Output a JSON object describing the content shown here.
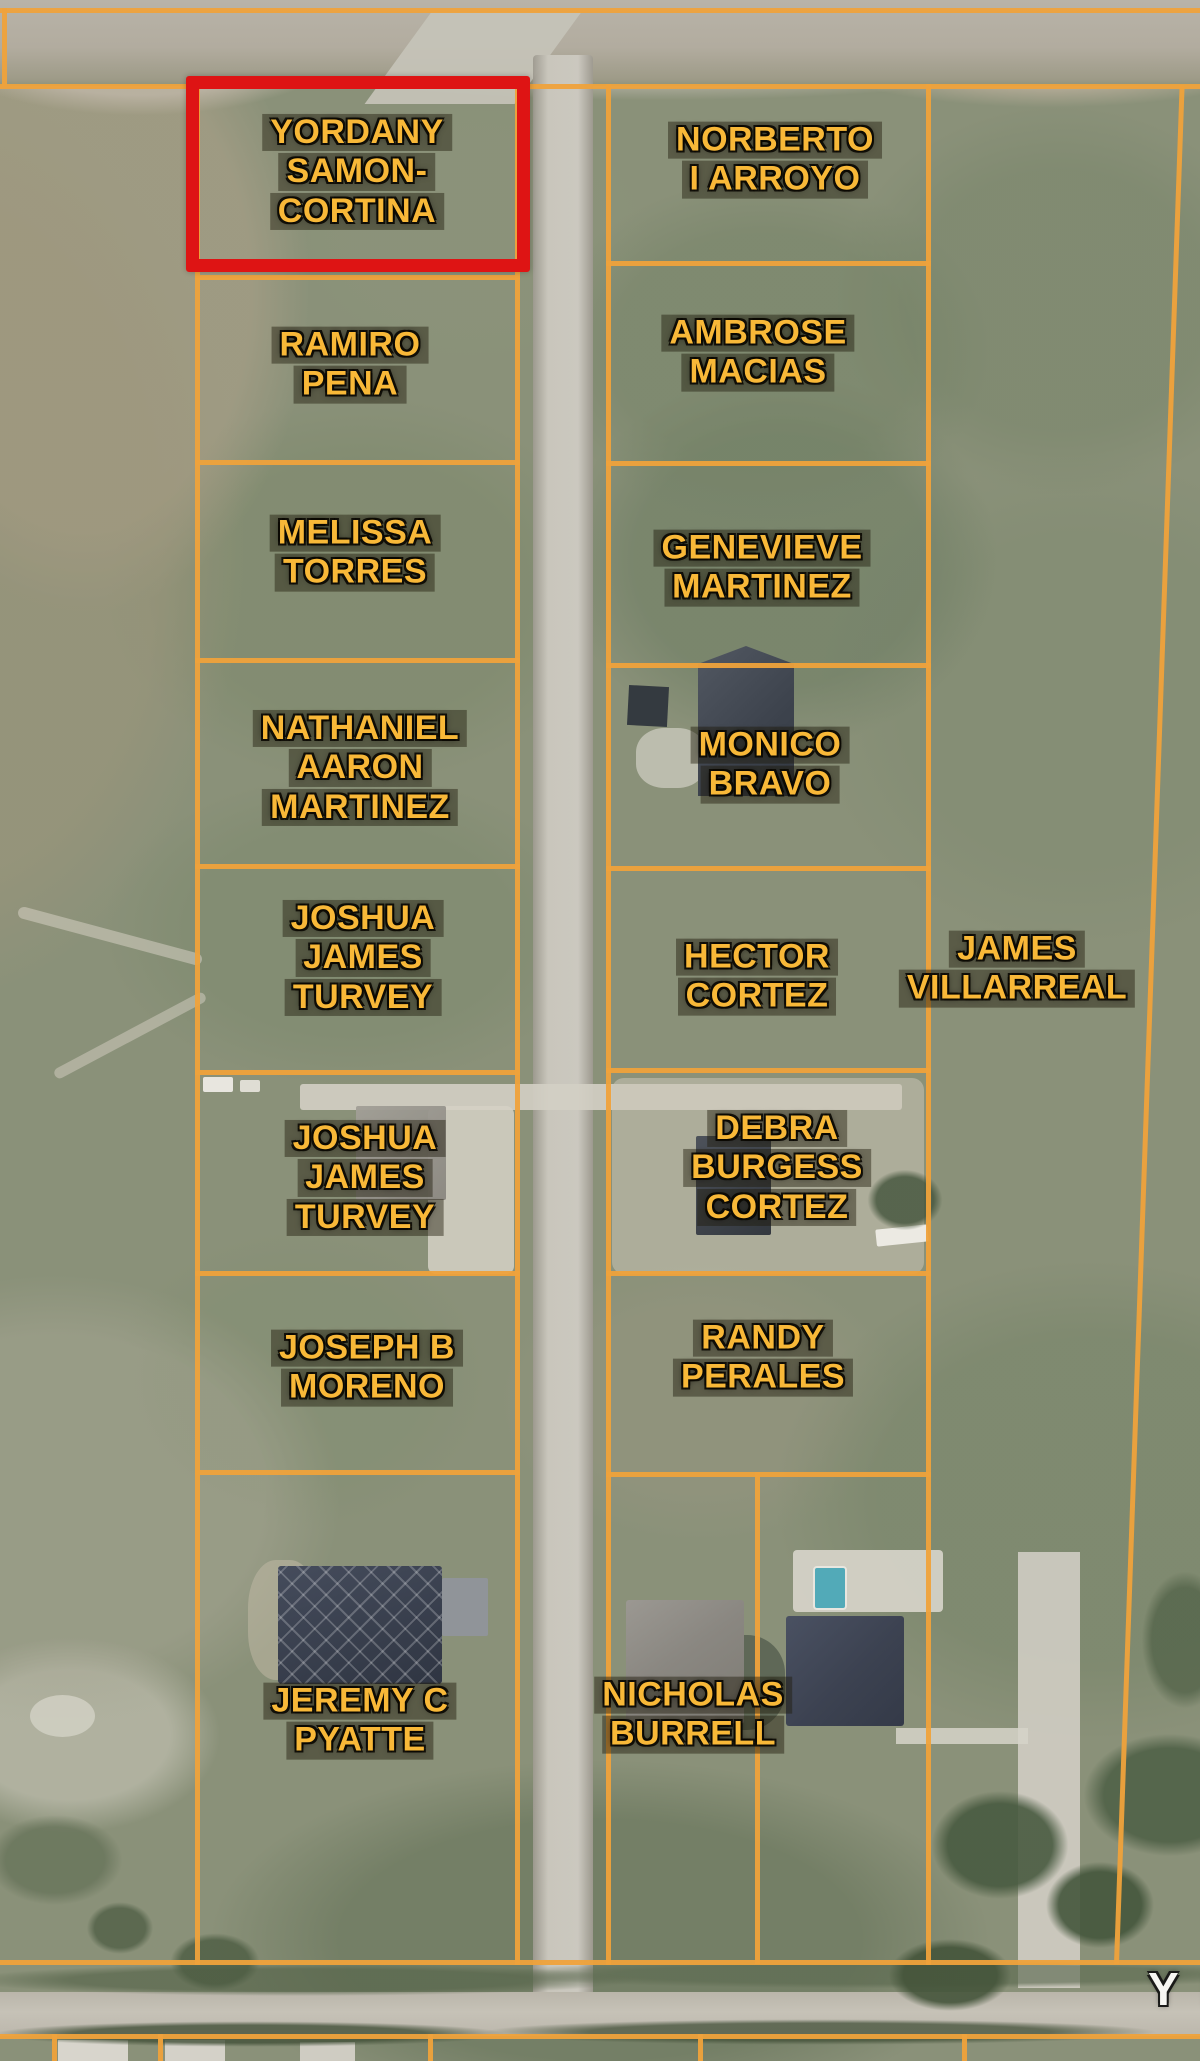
{
  "map": {
    "highlight_color": "#de1414",
    "parcel_line_color": "#efa23b",
    "label_color": "#f8b838",
    "road_name_label": "Y R",
    "highlighted_parcel": "YORDANY SAMON-CORTINA",
    "parcels": [
      {
        "name": "YORDANY SAMON-CORTINA",
        "lines": [
          "YORDANY",
          "SAMON-",
          "CORTINA"
        ],
        "highlighted": true
      },
      {
        "name": "RAMIRO PENA",
        "lines": [
          "RAMIRO",
          "PENA"
        ],
        "highlighted": false
      },
      {
        "name": "MELISSA TORRES",
        "lines": [
          "MELISSA",
          "TORRES"
        ],
        "highlighted": false
      },
      {
        "name": "NATHANIEL AARON MARTINEZ",
        "lines": [
          "NATHANIEL",
          "AARON",
          "MARTINEZ"
        ],
        "highlighted": false
      },
      {
        "name": "JOSHUA JAMES TURVEY",
        "lines": [
          "JOSHUA",
          "JAMES",
          "TURVEY"
        ],
        "highlighted": false
      },
      {
        "name": "JOSHUA JAMES TURVEY",
        "lines": [
          "JOSHUA",
          "JAMES",
          "TURVEY"
        ],
        "highlighted": false
      },
      {
        "name": "JOSEPH B MORENO",
        "lines": [
          "JOSEPH B",
          "MORENO"
        ],
        "highlighted": false
      },
      {
        "name": "JEREMY C PYATTE",
        "lines": [
          "JEREMY C",
          "PYATTE"
        ],
        "highlighted": false
      },
      {
        "name": "NORBERTO I ARROYO",
        "lines": [
          "NORBERTO",
          "I ARROYO"
        ],
        "highlighted": false
      },
      {
        "name": "AMBROSE MACIAS",
        "lines": [
          "AMBROSE",
          "MACIAS"
        ],
        "highlighted": false
      },
      {
        "name": "GENEVIEVE MARTINEZ",
        "lines": [
          "GENEVIEVE",
          "MARTINEZ"
        ],
        "highlighted": false
      },
      {
        "name": "MONICO BRAVO",
        "lines": [
          "MONICO",
          "BRAVO"
        ],
        "highlighted": false
      },
      {
        "name": "HECTOR CORTEZ",
        "lines": [
          "HECTOR",
          "CORTEZ"
        ],
        "highlighted": false
      },
      {
        "name": "DEBRA BURGESS CORTEZ",
        "lines": [
          "DEBRA",
          "BURGESS",
          "CORTEZ"
        ],
        "highlighted": false
      },
      {
        "name": "RANDY PERALES",
        "lines": [
          "RANDY",
          "PERALES"
        ],
        "highlighted": false
      },
      {
        "name": "NICHOLAS BURRELL",
        "lines": [
          "NICHOLAS",
          "BURRELL"
        ],
        "highlighted": false
      },
      {
        "name": "JAMES VILLARREAL",
        "lines": [
          "JAMES",
          "VILLARREAL"
        ],
        "highlighted": false
      }
    ]
  }
}
